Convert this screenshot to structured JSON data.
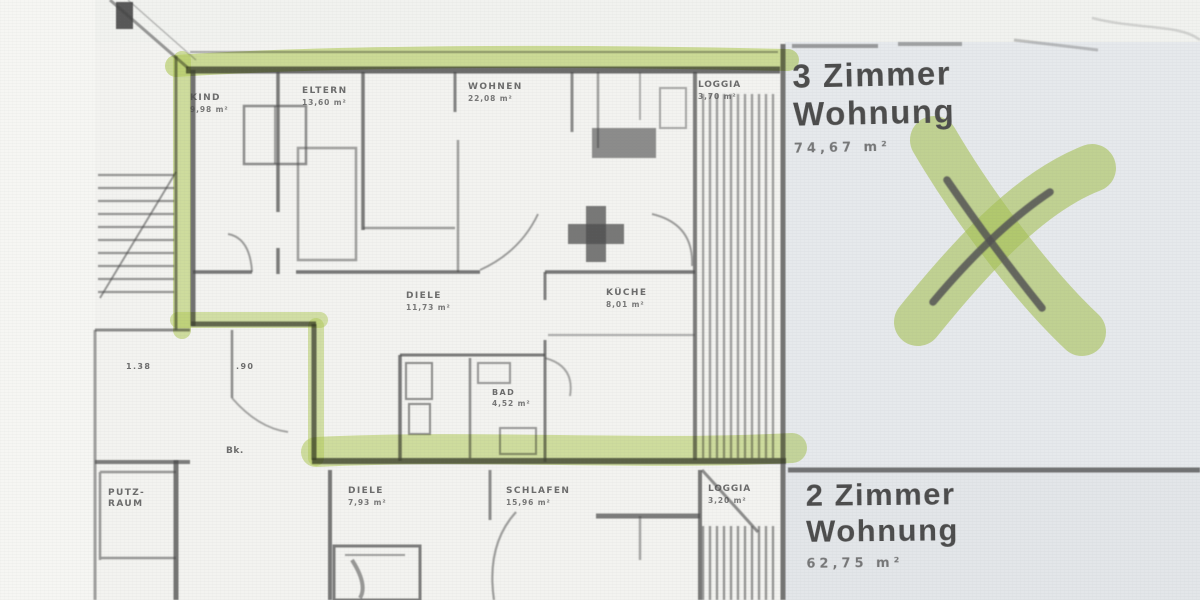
{
  "document_kind": "scanned floor plan",
  "apartments": {
    "three_room": {
      "title_line1": "3 Zimmer",
      "title_line2": "Wohnung",
      "area": "74,67 m²"
    },
    "two_room": {
      "title_line1": "2 Zimmer",
      "title_line2": "Wohnung",
      "area": "62,75 m²"
    }
  },
  "rooms": [
    {
      "id": "kind",
      "label": "KIND",
      "area": "9,98 m²"
    },
    {
      "id": "eltern",
      "label": "ELTERN",
      "area": "13,60 m²"
    },
    {
      "id": "wohnen",
      "label": "WOHNEN",
      "area": "22,08 m²"
    },
    {
      "id": "loggia-top",
      "label": "LOGGIA",
      "area": "3,70 m²"
    },
    {
      "id": "diele",
      "label": "DIELE",
      "area": "11,73 m²"
    },
    {
      "id": "kueche",
      "label": "KÜCHE",
      "area": "8,01 m²"
    },
    {
      "id": "bad",
      "label": "BAD",
      "area": "4,52 m²"
    },
    {
      "id": "diele-lower",
      "label": "DIELE",
      "area": "7,93 m²"
    },
    {
      "id": "schlafen",
      "label": "SCHLAFEN",
      "area": "15,96 m²"
    },
    {
      "id": "loggia-lower",
      "label": "LOGGIA",
      "area": "3,20 m²"
    },
    {
      "id": "putzraum",
      "label": "PUTZ-RAUM",
      "area": ""
    }
  ],
  "annotations": {
    "dim_a": "1.38",
    "dim_b": ".90",
    "mark_bk": "Bk."
  },
  "colors": {
    "highlighter": "#b9d45e",
    "ink": "#4a4a4a",
    "paper": "#f3f3f0",
    "margin_gray": "#e6e9ec"
  }
}
